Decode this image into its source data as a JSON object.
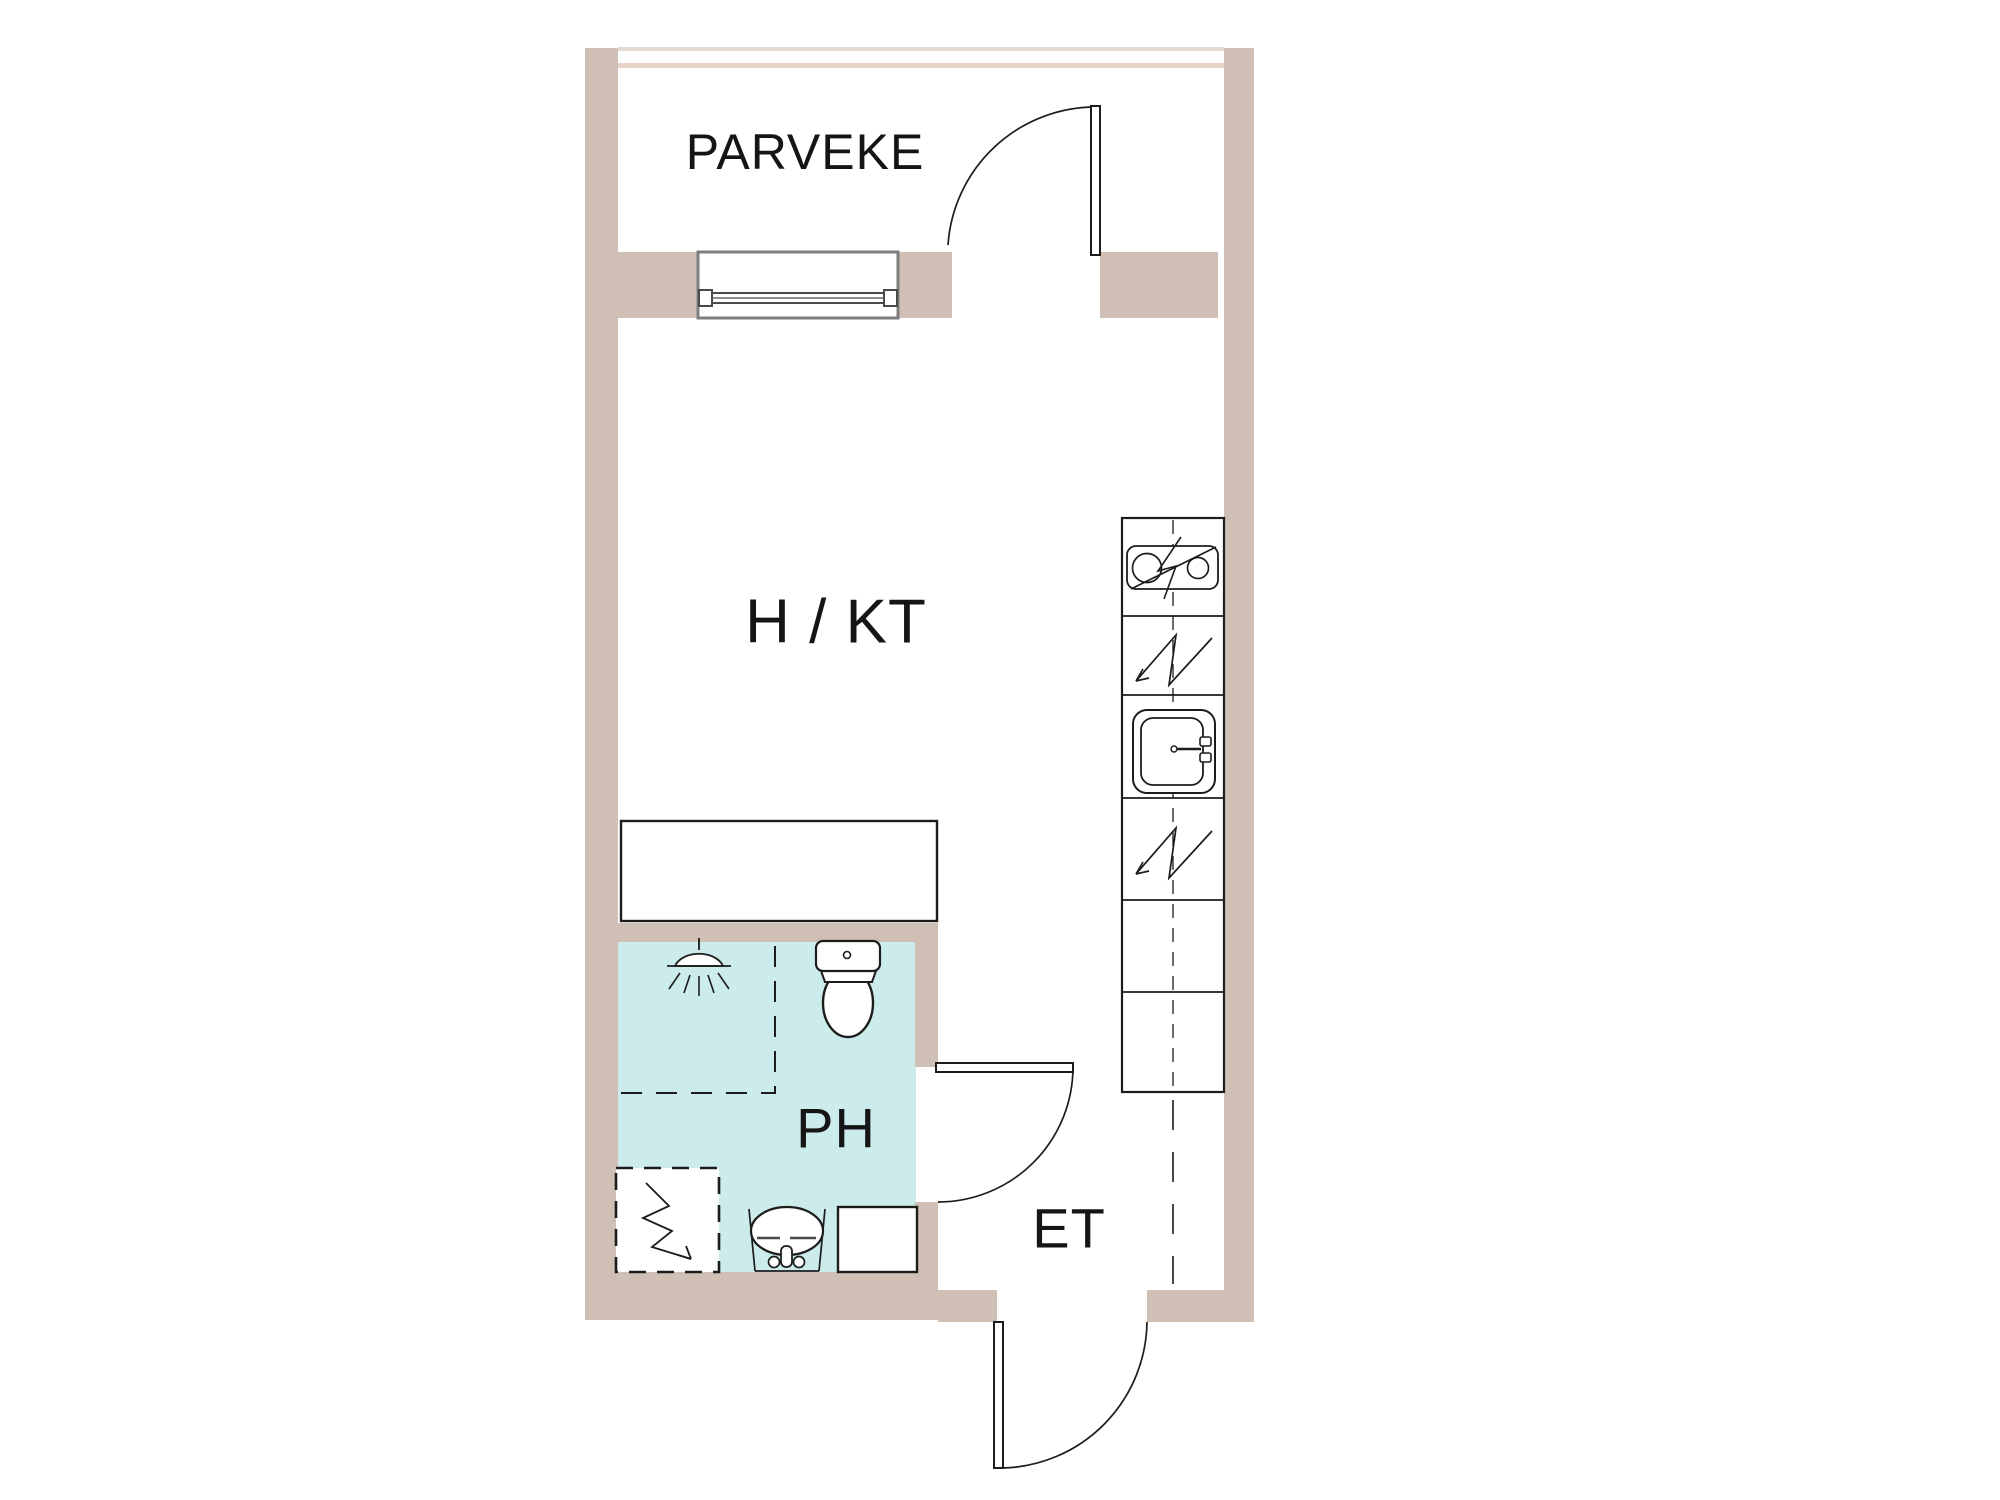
{
  "floorplan": {
    "rooms": [
      {
        "id": "balcony",
        "label": "PARVEKE"
      },
      {
        "id": "living-kitchen",
        "label": "H / KT"
      },
      {
        "id": "bathroom",
        "label": "PH"
      },
      {
        "id": "entry",
        "label": "ET"
      }
    ],
    "colors": {
      "wall": "#cfbfb4",
      "bathroom_floor": "#cbecea",
      "line": "#1c1c1c",
      "window_frame": "#7e7e7e",
      "glass": "#4a4a4a",
      "railing_outer": "#e4dbd3",
      "railing_inner": "#e7d2c8",
      "background": "#ffffff",
      "label_text": "#151515"
    },
    "fixtures": [
      "balcony-door",
      "balcony-window",
      "kitchen-counter",
      "cooktop",
      "electric-appliance-upper",
      "kitchen-sink",
      "electric-appliance-lower",
      "kitchen-cabinets",
      "shower",
      "shower-enclosure",
      "toilet",
      "washing-machine-reservation",
      "washbasin",
      "bathroom-cabinet",
      "bathroom-door",
      "entry-door"
    ]
  }
}
